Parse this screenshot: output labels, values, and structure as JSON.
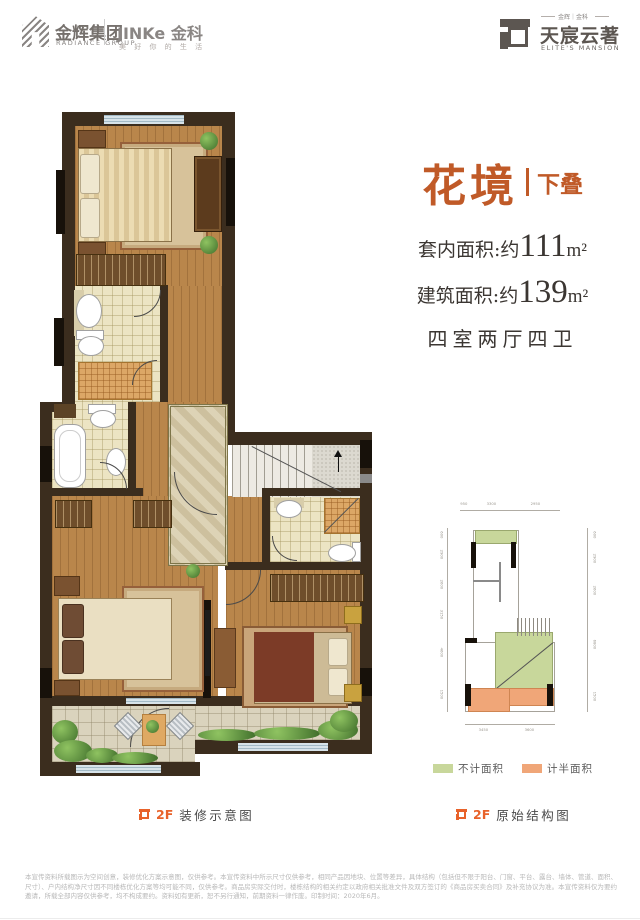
{
  "header": {
    "radiance_cn": "金辉集团",
    "radiance_en": "RADIANCE GROUP",
    "jinke_name": "JINKe 金科",
    "jinke_slogan": "美 好 你 的 生 活",
    "mansion_small": "金辉｜金科",
    "mansion_cn": "天宸云著",
    "mansion_en": "ELITE'S MANSION"
  },
  "title": {
    "name": "花境",
    "tag": "下叠"
  },
  "specs": {
    "inner_label": "套内面积:约",
    "inner_value": "111",
    "inner_unit": "m²",
    "build_label": "建筑面积:约",
    "build_value": "139",
    "build_unit": "m²",
    "rooms": "四室两厅四卫"
  },
  "legend": {
    "green_label": "不计面积",
    "green_color": "#c8d79b",
    "orange_label": "计半面积",
    "orange_color": "#f0a678"
  },
  "captions": {
    "left_floor": "2F",
    "left_text": "装修示意图",
    "right_floor": "2F",
    "right_text": "原始结构图"
  },
  "struct": {
    "top_dims": [
      "950",
      "3300",
      "2950"
    ],
    "left_dims": [
      "600",
      "2900",
      "2600",
      "3150",
      "4600",
      "1500"
    ],
    "right_dims": [
      "600",
      "2900",
      "2600",
      "6800",
      "1500"
    ],
    "bottom_dims": [
      "3450",
      "3600"
    ]
  },
  "disclaimer": "本宣传资料所载图示为空间创意，装修优化方案示意图，仅供参考。本宣传资料中所示尺寸仅供参考，相同产品因地块、位置等差异，具体结构（包括但不限于阳台、门窗、平台、露台、墙体、管道、面积、尺寸）、户内结构净尺寸因不同楼栋优化方案等均可能不同，仅供参考。商品房实际交付时，楼栋结构的相关约定以政府相关批准文件及双方签订的《商品房买卖合同》及补充协议为准。本宣传资料仅为要约邀请，所载全部内容仅供参考，均不构成要约。资料如有更新，恕不另行通知，前期资料一律作废。印制时间：2020年6月。"
}
